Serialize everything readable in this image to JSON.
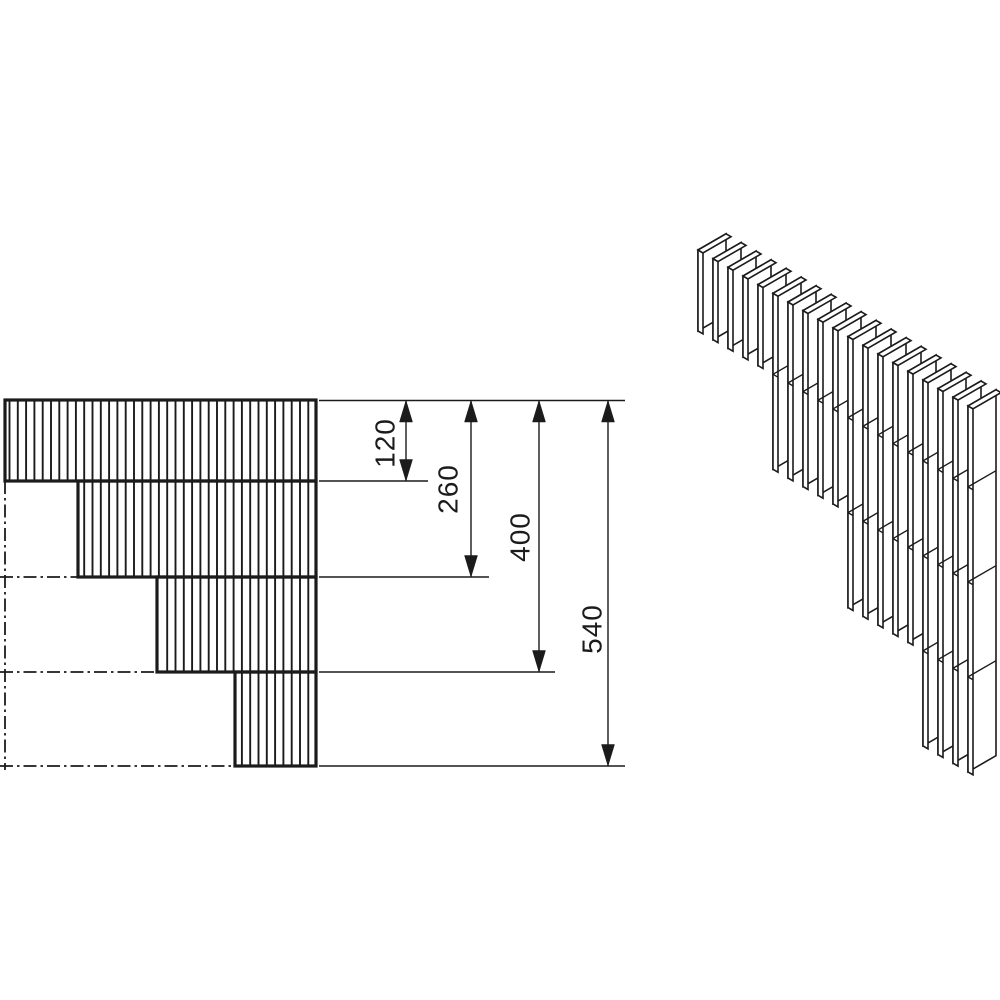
{
  "drawing": {
    "dimension_labels": [
      "120",
      "260",
      "400",
      "540"
    ],
    "line_color": "#1b1b1b",
    "background_color": "#ffffff"
  }
}
